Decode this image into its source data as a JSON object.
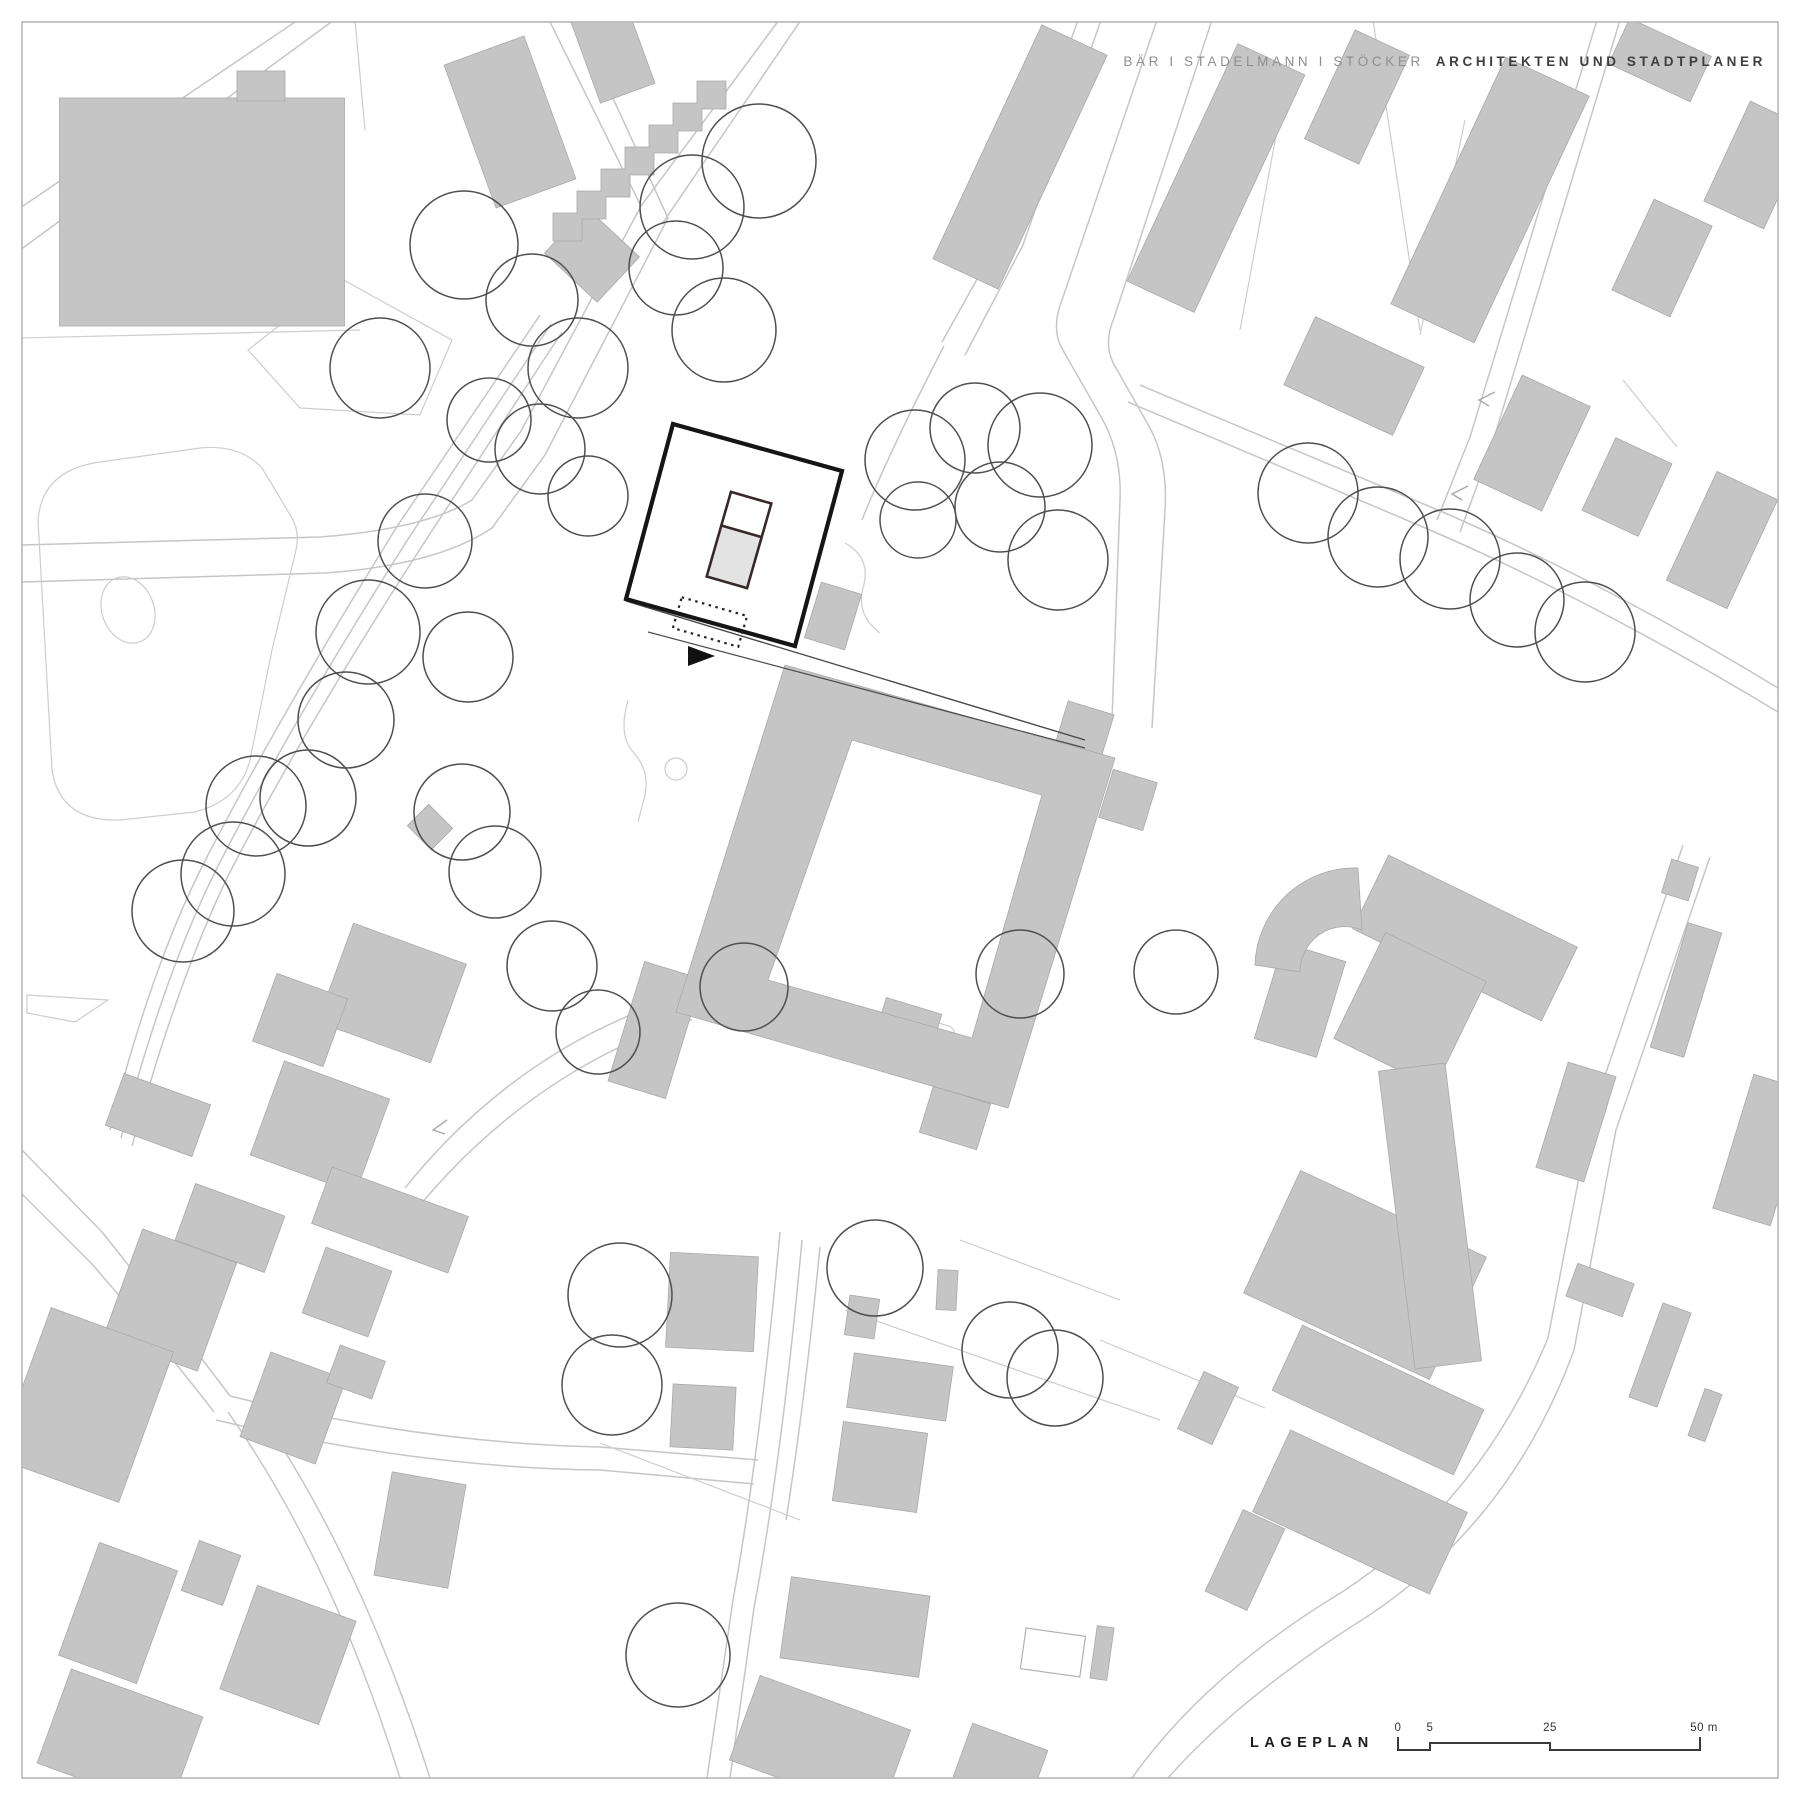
{
  "header": {
    "firm_light": "BÄR I STADELMANN I STÖCKER",
    "firm_bold": "ARCHITEKTEN UND STADTPLANER"
  },
  "footer": {
    "plan_title": "LAGEPLAN",
    "scale_bar": {
      "ticks": [
        "0",
        "5",
        "25",
        "50 m"
      ]
    }
  },
  "colors": {
    "paper": "#ffffff",
    "frame": "#b5b5b5",
    "road": "#c6c6c6",
    "parcel": "#cdcdcd",
    "bld": "#c5c5c5",
    "bld-stroke": "#a9a9a9",
    "tree": "#4f4f4f",
    "site": "#151515",
    "nb-stroke": "#37292a",
    "nb-fill": "#e3e3e3",
    "txt-light": "#8f8f8f",
    "txt-dark": "#3e3e3e",
    "scale": "#3a3a3a",
    "title": "#1b1b1b"
  },
  "map": {
    "trees": [
      [
        759,
        161,
        57
      ],
      [
        692,
        207,
        52
      ],
      [
        676,
        268,
        47
      ],
      [
        724,
        330,
        52
      ],
      [
        464,
        245,
        54
      ],
      [
        532,
        300,
        46
      ],
      [
        578,
        368,
        50
      ],
      [
        540,
        449,
        45
      ],
      [
        588,
        496,
        40
      ],
      [
        380,
        368,
        50
      ],
      [
        489,
        420,
        42
      ],
      [
        425,
        541,
        47
      ],
      [
        368,
        632,
        52
      ],
      [
        468,
        657,
        45
      ],
      [
        346,
        720,
        48
      ],
      [
        308,
        798,
        48
      ],
      [
        256,
        806,
        50
      ],
      [
        233,
        874,
        52
      ],
      [
        183,
        911,
        51
      ],
      [
        462,
        812,
        48
      ],
      [
        495,
        872,
        46
      ],
      [
        552,
        966,
        45
      ],
      [
        598,
        1032,
        42
      ],
      [
        744,
        987,
        44
      ],
      [
        915,
        460,
        50
      ],
      [
        975,
        428,
        45
      ],
      [
        1040,
        445,
        52
      ],
      [
        1000,
        507,
        45
      ],
      [
        918,
        520,
        38
      ],
      [
        1058,
        560,
        50
      ],
      [
        1308,
        493,
        50
      ],
      [
        1378,
        537,
        50
      ],
      [
        1450,
        559,
        50
      ],
      [
        1517,
        600,
        47
      ],
      [
        1585,
        632,
        50
      ],
      [
        1020,
        974,
        44
      ],
      [
        1176,
        972,
        42
      ],
      [
        875,
        1268,
        48
      ],
      [
        1010,
        1350,
        48
      ],
      [
        1055,
        1378,
        48
      ],
      [
        620,
        1295,
        52
      ],
      [
        612,
        1385,
        50
      ],
      [
        678,
        1655,
        52
      ]
    ],
    "building_rects": [
      [
        202,
        212,
        285,
        228,
        0
      ],
      [
        261,
        86,
        48,
        30,
        0
      ],
      [
        592,
        255,
        72,
        62,
        43
      ],
      [
        510,
        122,
        85,
        152,
        -20
      ],
      [
        612,
        50,
        58,
        92,
        -20
      ],
      [
        1020,
        157,
        72,
        258,
        25
      ],
      [
        1216,
        178,
        74,
        262,
        25
      ],
      [
        1357,
        97,
        60,
        120,
        25
      ],
      [
        1490,
        200,
        92,
        272,
        25
      ],
      [
        1660,
        60,
        90,
        50,
        25
      ],
      [
        1757,
        165,
        66,
        110,
        25
      ],
      [
        1662,
        258,
        64,
        100,
        25
      ],
      [
        1354,
        376,
        120,
        75,
        25
      ],
      [
        1532,
        443,
        75,
        115,
        25
      ],
      [
        1627,
        487,
        62,
        80,
        25
      ],
      [
        1722,
        540,
        67,
        120,
        25
      ],
      [
        1680,
        880,
        28,
        35,
        17
      ],
      [
        1686,
        990,
        35,
        130,
        17
      ],
      [
        1576,
        1122,
        50,
        110,
        17
      ],
      [
        1762,
        1150,
        60,
        140,
        17
      ],
      [
        392,
        993,
        120,
        105,
        20
      ],
      [
        300,
        1020,
        75,
        72,
        20
      ],
      [
        320,
        1127,
        112,
        100,
        20
      ],
      [
        158,
        1115,
        92,
        55,
        20
      ],
      [
        430,
        827,
        34,
        30,
        45
      ],
      [
        230,
        1228,
        95,
        60,
        20
      ],
      [
        170,
        1300,
        100,
        115,
        20
      ],
      [
        85,
        1405,
        130,
        160,
        20
      ],
      [
        293,
        1408,
        80,
        90,
        20
      ],
      [
        347,
        1292,
        70,
        70,
        20
      ],
      [
        356,
        1372,
        48,
        40,
        20
      ],
      [
        420,
        1530,
        75,
        105,
        10
      ],
      [
        211,
        1573,
        44,
        53,
        20
      ],
      [
        118,
        1613,
        83,
        120,
        20
      ],
      [
        288,
        1655,
        105,
        110,
        20
      ],
      [
        120,
        1740,
        140,
        100,
        20
      ],
      [
        390,
        1220,
        145,
        60,
        20
      ],
      [
        712,
        1302,
        88,
        95,
        3
      ],
      [
        703,
        1417,
        63,
        63,
        3
      ],
      [
        900,
        1387,
        100,
        55,
        8
      ],
      [
        880,
        1467,
        85,
        80,
        8
      ],
      [
        855,
        1627,
        140,
        82,
        8
      ],
      [
        947,
        1290,
        20,
        40,
        3
      ],
      [
        862,
        1317,
        30,
        40,
        8
      ],
      [
        1102,
        1653,
        17,
        53,
        8
      ],
      [
        820,
        1745,
        160,
        90,
        20
      ],
      [
        1000,
        1765,
        80,
        60,
        20
      ],
      [
        1365,
        1275,
        205,
        135,
        25
      ],
      [
        1378,
        1400,
        200,
        72,
        25
      ],
      [
        1360,
        1512,
        195,
        90,
        25
      ],
      [
        1208,
        1408,
        38,
        63,
        25
      ],
      [
        1245,
        1560,
        46,
        90,
        25
      ],
      [
        1600,
        1290,
        60,
        35,
        20
      ],
      [
        1660,
        1355,
        30,
        100,
        20
      ],
      [
        1705,
        1415,
        18,
        50,
        20
      ],
      [
        833,
        616,
        42,
        58,
        17
      ],
      [
        1085,
        728,
        48,
        42,
        17
      ],
      [
        1128,
        800,
        46,
        50,
        17
      ],
      [
        908,
        1026,
        58,
        42,
        17
      ],
      [
        955,
        1118,
        60,
        48,
        17
      ],
      [
        655,
        1030,
        60,
        125,
        17
      ],
      [
        1300,
        1000,
        65,
        100,
        17
      ],
      [
        1465,
        938,
        210,
        82,
        26
      ],
      [
        1410,
        1010,
        112,
        118,
        26
      ],
      [
        1430,
        1216,
        67,
        300,
        -7
      ]
    ]
  }
}
